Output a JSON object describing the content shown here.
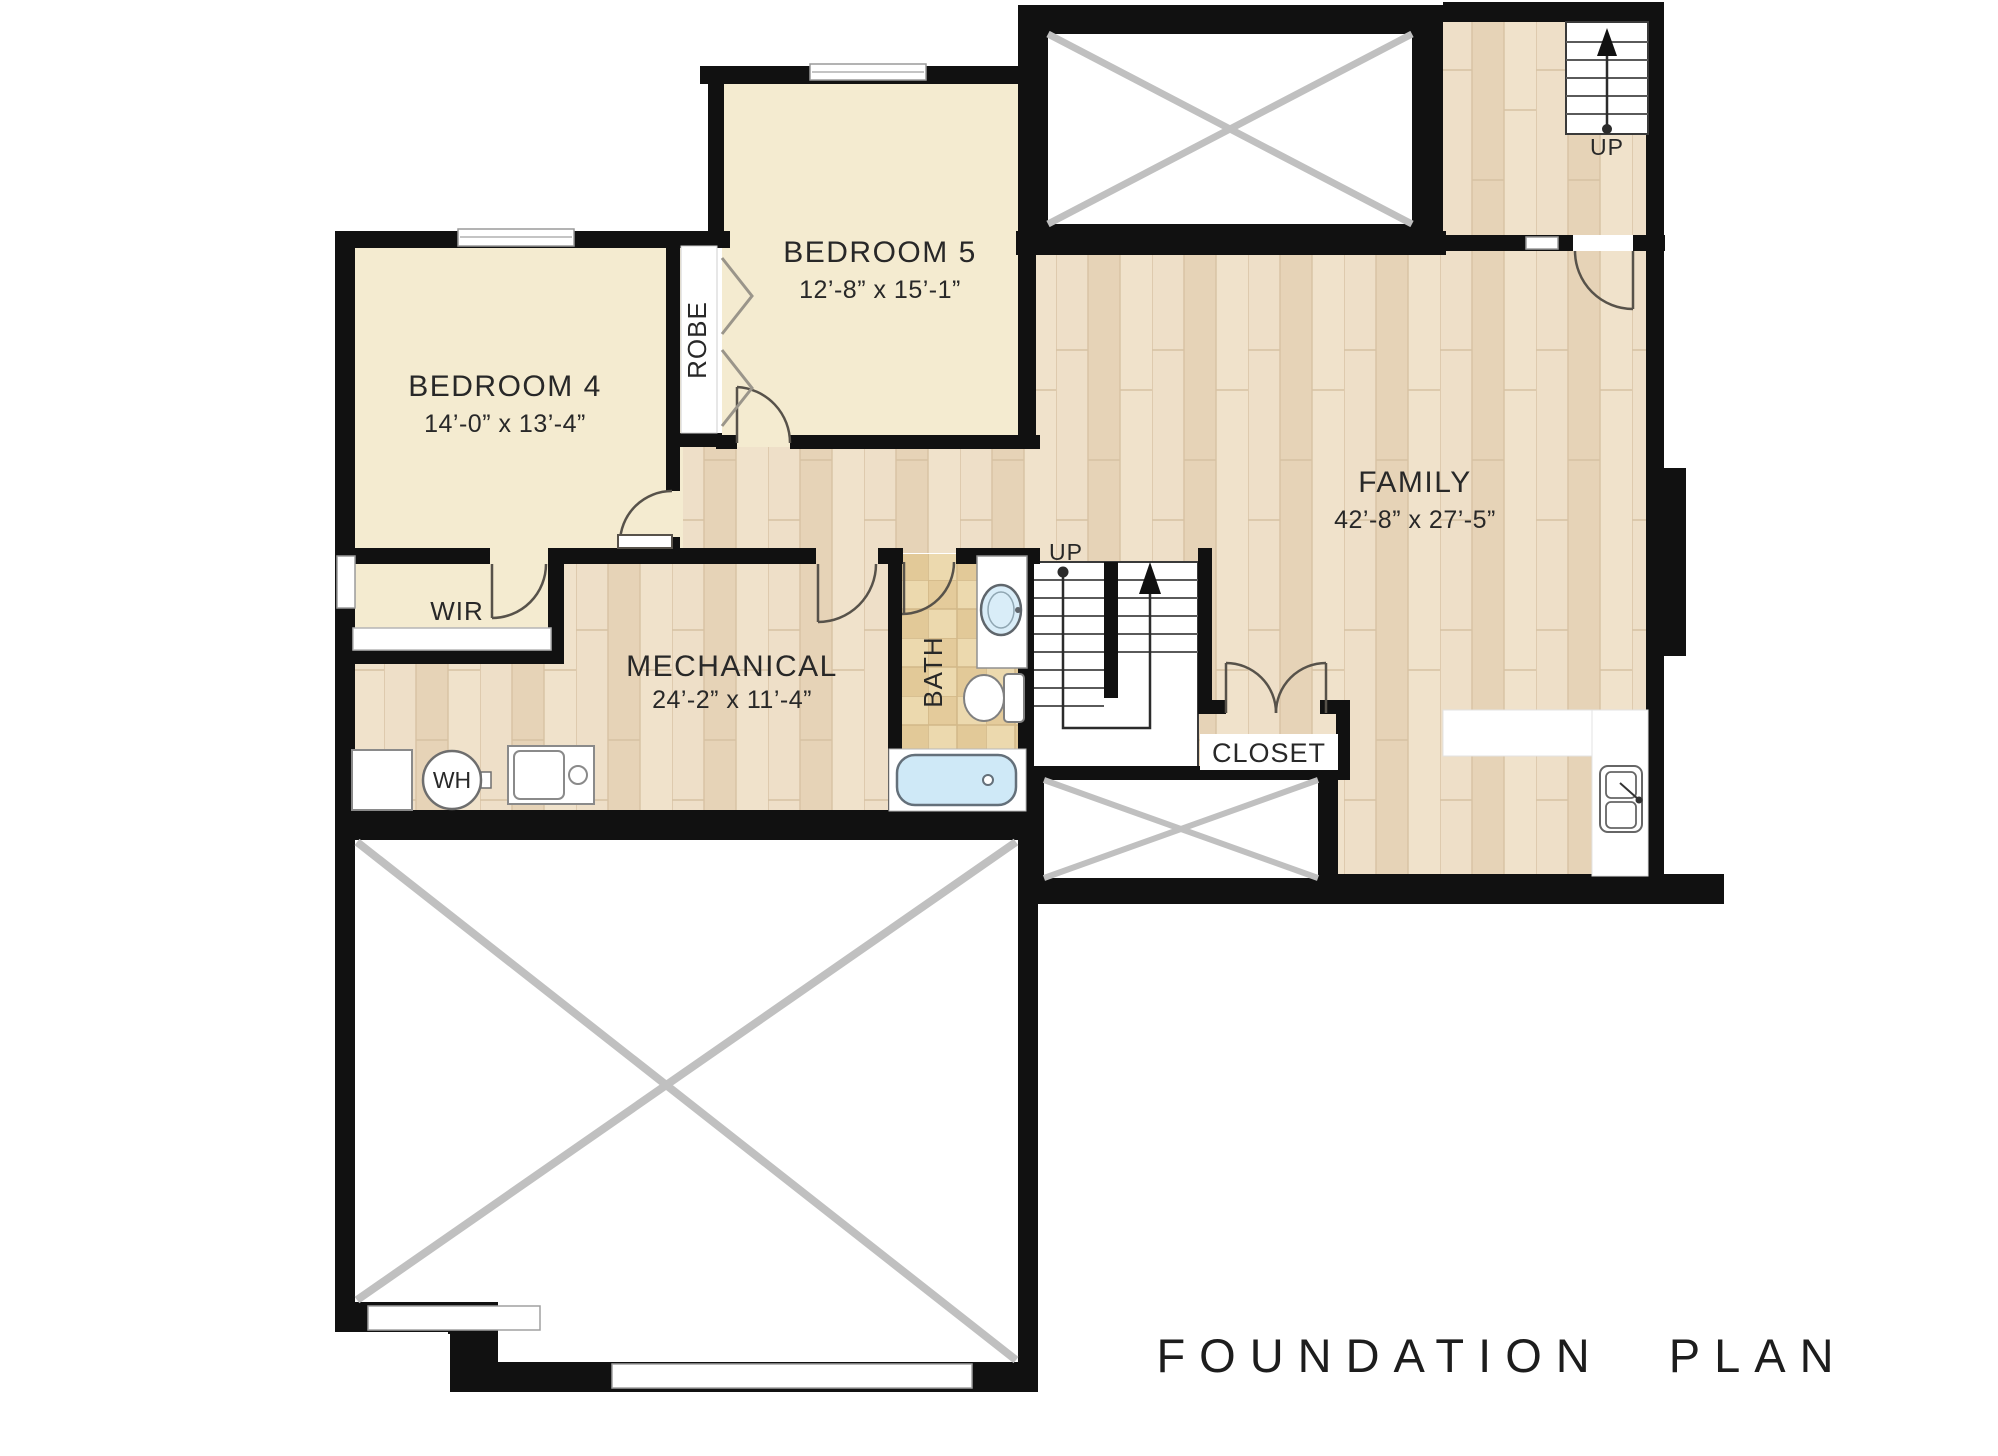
{
  "title": "FOUNDATION PLAN",
  "rooms": {
    "bedroom5": {
      "name": "BEDROOM 5",
      "dims": "12’-8” x 15’-1”"
    },
    "bedroom4": {
      "name": "BEDROOM 4",
      "dims": "14’-0” x 13’-4”"
    },
    "family": {
      "name": "FAMILY",
      "dims": "42’-8” x 27’-5”"
    },
    "mechanical": {
      "name": "MECHANICAL",
      "dims": "24’-2” x 11’-4”"
    },
    "wir": {
      "name": "WIR"
    },
    "robe": {
      "name": "ROBE"
    },
    "bath": {
      "name": "BATH"
    },
    "closet": {
      "name": "CLOSET"
    }
  },
  "stairs": {
    "main": {
      "direction": "UP"
    },
    "entry": {
      "direction": "UP"
    }
  },
  "fixtures": {
    "water_heater": "WH"
  },
  "colors": {
    "wall": "#111111",
    "bedroom_fill": "#f4ebd0",
    "wood_light": "#ecdcc3",
    "tile": "#e7d2a5",
    "tub": "#cfe9f7",
    "x_brace": "#c0c0c0"
  }
}
